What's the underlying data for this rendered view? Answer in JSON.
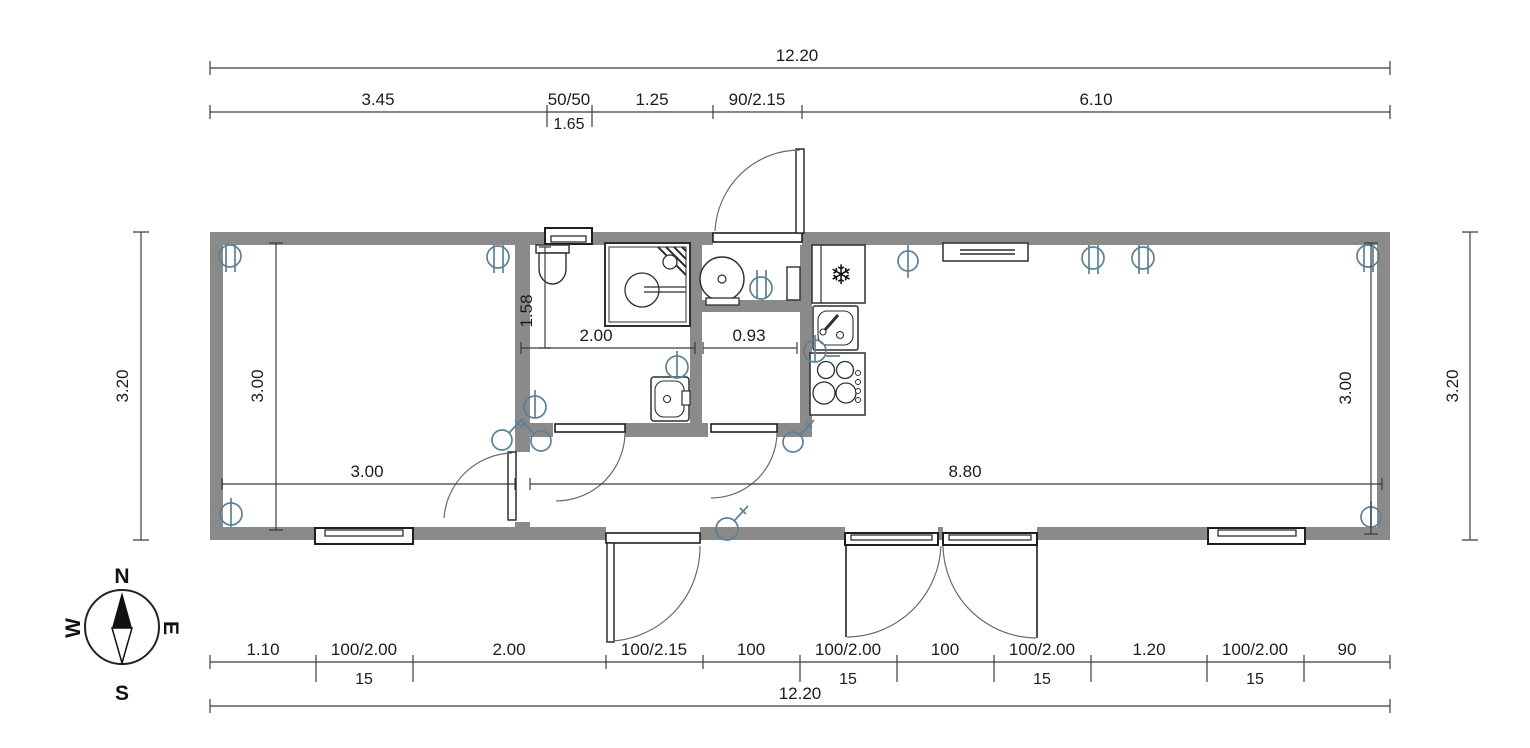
{
  "compass": {
    "north": "N",
    "east": "E",
    "south": "S",
    "west": "W"
  },
  "colors": {
    "wall": "#8a8a8a",
    "fixture_line": "#2f2f2f",
    "dim_line": "#3c3c3c",
    "door_arc": "#6b6b6b",
    "electric": "#5b8196"
  },
  "icons": {
    "fridge_snowflake": "❄"
  },
  "dims": {
    "top_overall": "12.20",
    "top_row": [
      "3.45",
      "50/50",
      "1.25",
      "90/2.15",
      "6.10"
    ],
    "top_window_sill": "1.65",
    "bottom_row": [
      "1.10",
      "100/2.00",
      "2.00",
      "100/2.15",
      "100",
      "100/2.00",
      "100",
      "100/2.00",
      "1.20",
      "100/2.00",
      "90"
    ],
    "bottom_sill": "15",
    "bottom_overall": "12.20",
    "left_outer": "3.20",
    "right_outer": "3.20",
    "bedroom_depth": "3.00",
    "bedroom_width": "3.00",
    "living_depth": "3.00",
    "living_width": "8.80",
    "bathroom_width": "2.00",
    "bathroom_depth": "1.58",
    "utility_width": "0.93"
  }
}
